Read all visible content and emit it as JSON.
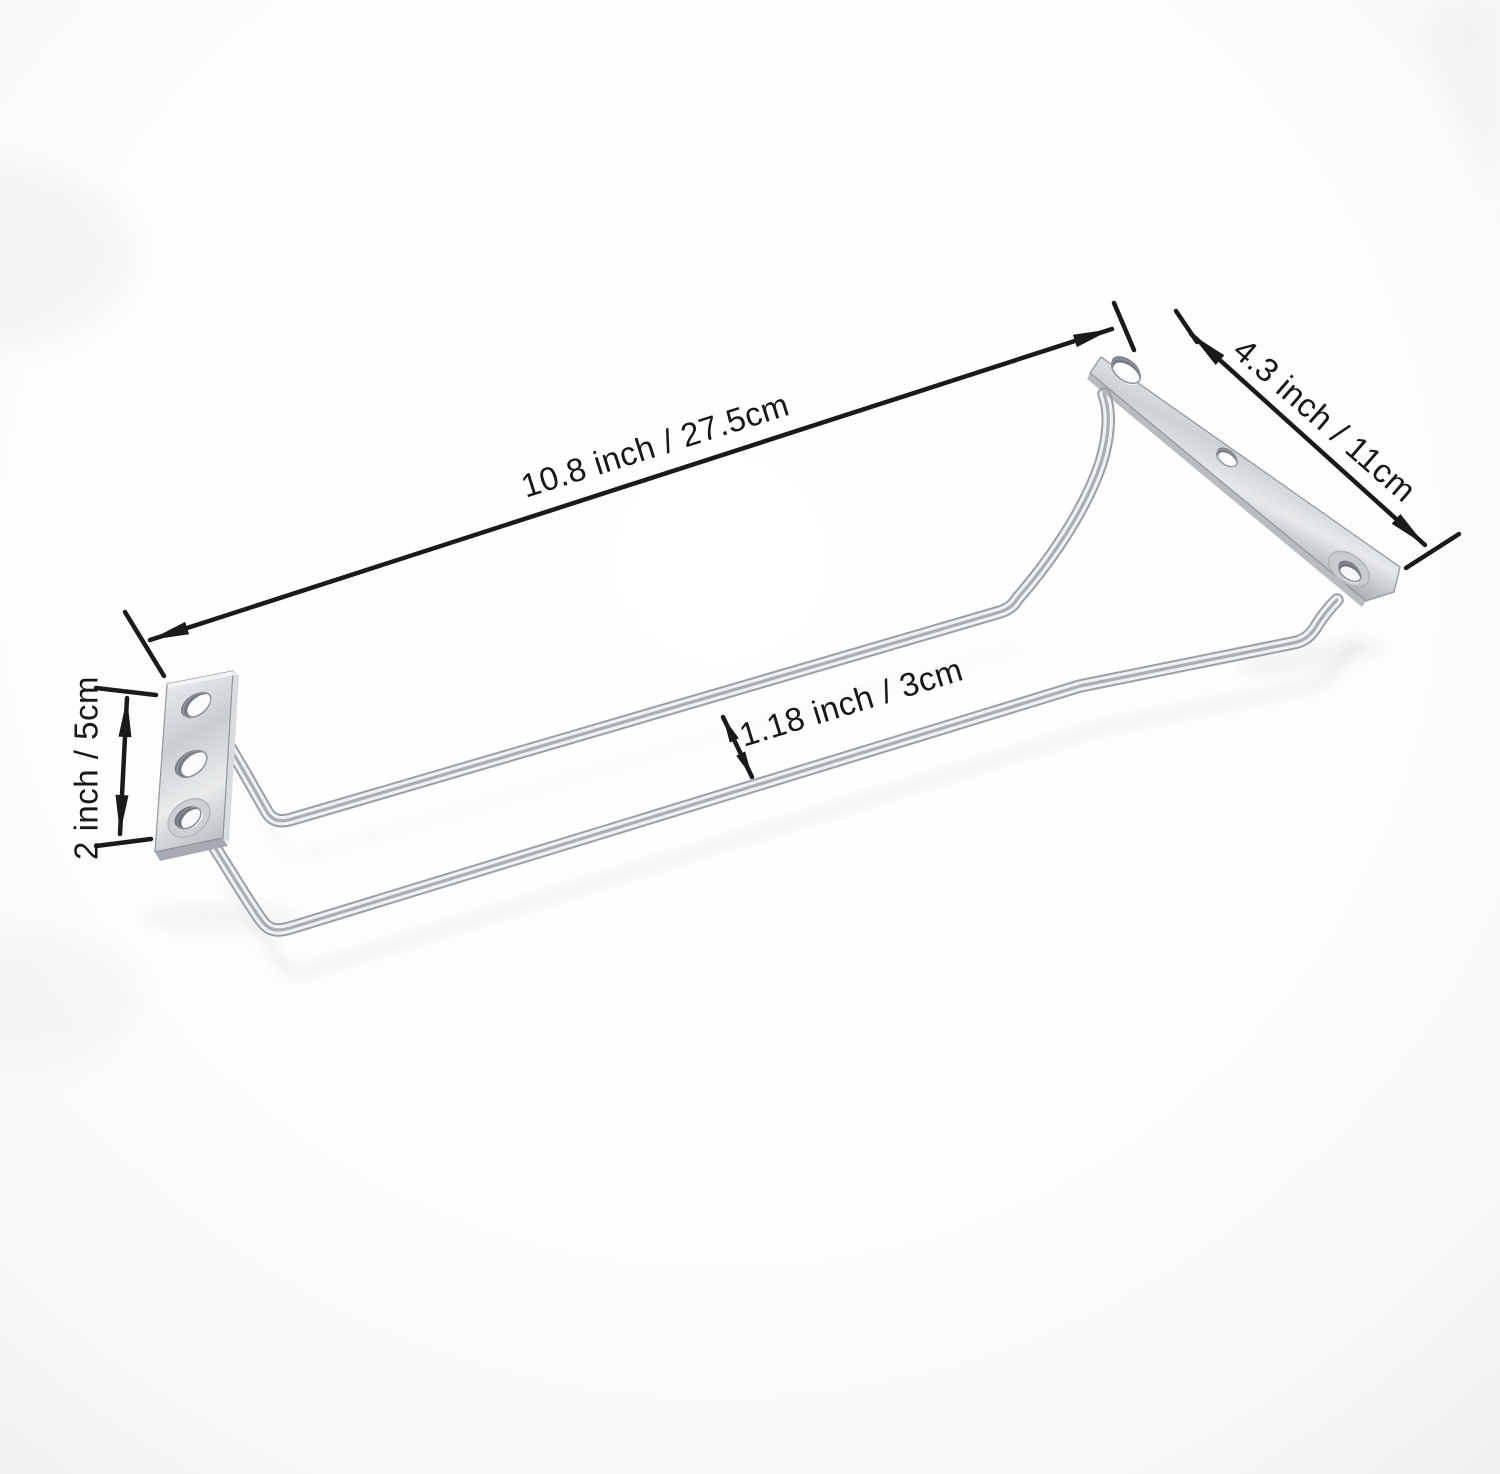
{
  "image": {
    "kind": "product-dimension-photo",
    "subject": "chrome stemware wine-glass rack with two rails and two mounting plates",
    "background_color": "#fcfcfd",
    "metal_base_color": "#9aa0a6",
    "metal_highlight_color": "#eef0f1",
    "annotation_ink": "#1a1a1a"
  },
  "dimensions": {
    "length": {
      "label": "10.8 inch / 27.5cm"
    },
    "plate_length": {
      "label": "4.3 inch / 11cm"
    },
    "plate_height": {
      "label": "2 inch / 5cm"
    },
    "rail_gap": {
      "label": "1.18 inch / 3cm"
    }
  }
}
